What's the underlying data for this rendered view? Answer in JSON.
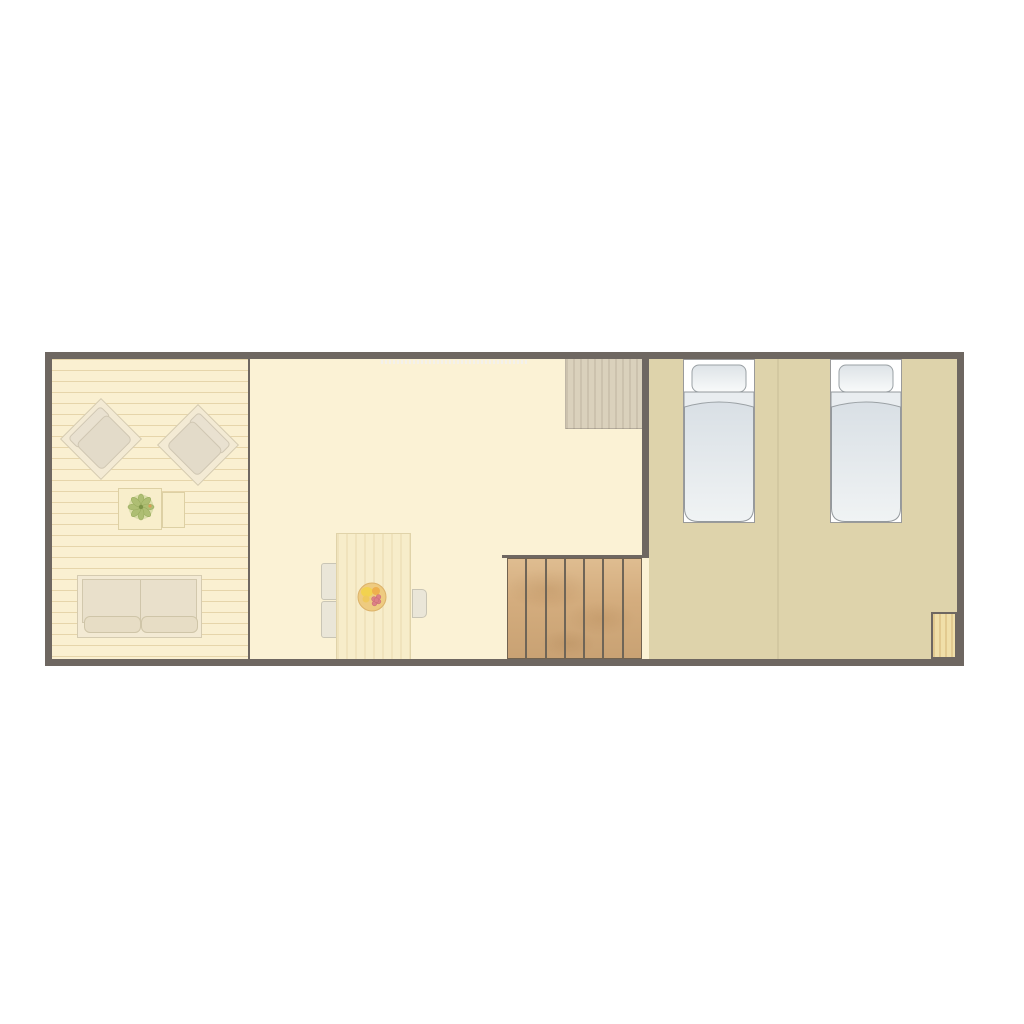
{
  "meta": {
    "description": "Top-down architectural floor plan of a long rectangular apartment, no text labels visible",
    "view": "floor-plan"
  },
  "palette": {
    "page-bg": "#ffffff",
    "wall": "#6e6761",
    "living-floor": "#faf0d1",
    "mid-floor": "#fbf2d5",
    "bedroom-floor": "#ded3ab",
    "closet-wood": "#dad1bc",
    "stair-wood": "#d4ad7e",
    "stair-divider": "#6f6557",
    "corner-wood": "#f0dfa9",
    "furniture-cream": "#f3ead4",
    "furniture-border": "#d5cbb0",
    "cushion": "#e3dbc9",
    "table-wood": "#f7edca",
    "chair-gray": "#eae6d8",
    "bed-frame": "#ffffff",
    "pillow-dark": "#dde3e7",
    "pillow-light": "#f8fafa",
    "blanket-dark": "#d7dee4",
    "blanket-light": "#f0f3f4",
    "plant-green": "#aabb6e",
    "fruit-base": "#eecb80",
    "window-tick": "#f3f1ec"
  },
  "rooms": [
    {
      "id": "living-area",
      "floor": "wood-planks",
      "furniture": [
        "armchair",
        "armchair",
        "coffee-table",
        "side-table",
        "potted-plant",
        "two-seat-sofa"
      ]
    },
    {
      "id": "dining-area",
      "floor": "plain",
      "furniture": [
        "dining-table",
        "dining-chair",
        "dining-chair",
        "dining-chair",
        "fruit-bowl",
        "closet",
        "staircase"
      ]
    },
    {
      "id": "bedroom",
      "floor": "plain",
      "furniture": [
        "single-bed",
        "single-bed",
        "corner-floor-mat"
      ]
    }
  ],
  "stairs": {
    "treads": 7
  },
  "beds": {
    "count": 2
  },
  "window_ticks": {
    "count": 37
  }
}
